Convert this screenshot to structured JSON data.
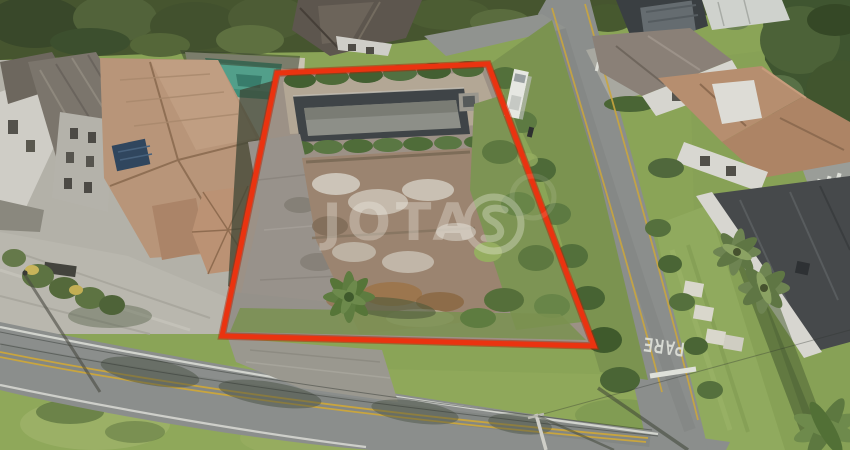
{
  "meta": {
    "type": "aerial-drone-photograph",
    "subject": "vacant-residential-lot-for-sale-with-red-boundary-outline"
  },
  "watermark": {
    "text": "JOTA",
    "logo": "s-monogram-in-circle",
    "color": "#f5f2ea",
    "opacity": "0.33"
  },
  "road_markings": {
    "stop_text": "PARE",
    "stop_line": "white-transverse-bar",
    "center_line": "double-yellow"
  },
  "boundary": {
    "color": "#ea3310",
    "points_str": "277,73 488,64 594,346 222,336",
    "shape": "quadrilateral"
  },
  "palette": {
    "boundary_red": "#ea3310",
    "road_gray": "#8b8e8c",
    "marking_white": "#dfe1da",
    "lane_yellow": "#c9a53e",
    "grass_green": "#8aa457",
    "forest_green": "#46552f",
    "lot_dirt_brown": "#9b8470",
    "debris_white": "#d5cfc4",
    "terracotta_roof": "#b68e6f",
    "dark_roof": "#46494b",
    "swimming_pool_teal": "#3f8f7a",
    "empty_pool_dark": "#3f4447",
    "watermark_white": "#f5f2ea"
  },
  "scene": {
    "objects": [
      "forest-canopy-top",
      "left-house-terracotta-roof-with-solar-panels",
      "left-house-swimming-pool",
      "left-driveway-with-palms",
      "vacant-lot-with-empty-pool-and-rubble",
      "lot-palm-tree",
      "bottom-road-with-double-yellow-line",
      "right-road-with-pare-marking",
      "white-van-parked",
      "top-right-houses",
      "right-house-with-two-palms",
      "utility-pole-and-wires"
    ]
  }
}
